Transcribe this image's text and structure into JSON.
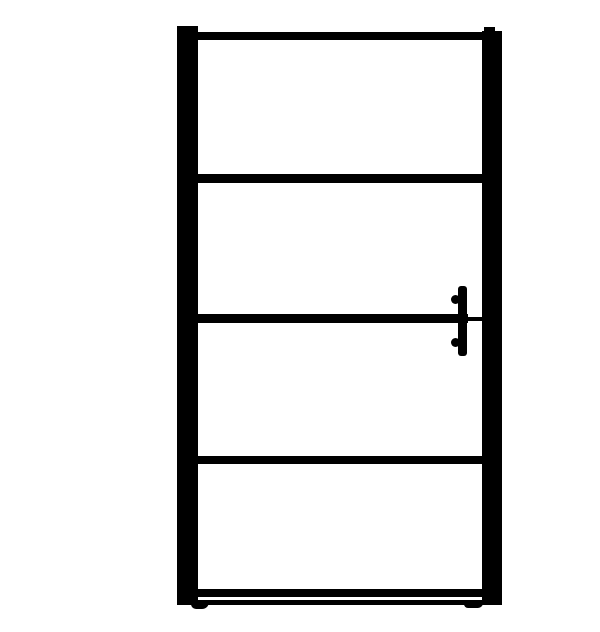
{
  "image": {
    "type": "product-photo",
    "subject": "Black framed glass shower door",
    "aria_label": "Front view of a black-framed glass shower door: two vertical side posts, a top rail and three horizontal crossbars dividing four clear glass panels, a vertical handle bar with two round mounts on the right side at mid height, and a bottom rail above a floor track with small end feet."
  },
  "colors": {
    "frame": "#000000",
    "background": "#ffffff"
  },
  "parts": [
    "left-post",
    "right-post",
    "right-post-tab",
    "top-rail",
    "crossbar-upper",
    "crossbar-middle",
    "crossbar-middle-thin",
    "crossbar-lower",
    "bottom-rail",
    "floor-track",
    "foot-left",
    "foot-right",
    "handle-bar",
    "handle-mount-top",
    "handle-mount-bottom",
    "glass-panel-1",
    "glass-panel-2",
    "glass-panel-3",
    "glass-panel-4"
  ]
}
